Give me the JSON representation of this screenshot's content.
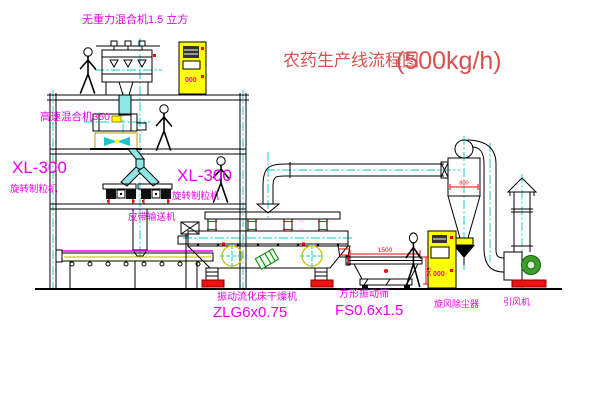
{
  "title": {
    "main": "农药生产线流程图",
    "capacity": "(500kg/h)"
  },
  "labels": {
    "gravity_mixer": "无重力混合机1.5 立方",
    "high_speed_mixer": "高速混合机350",
    "granulator_left_model": "XL-300",
    "granulator_left_name": "旋转制粒机",
    "granulator_right_model": "XL-300",
    "granulator_right_name": "旋转制粒机",
    "belt_conveyor": "皮带输送机",
    "dryer_name": "振动流化床干燥机",
    "dryer_model": "ZLG6x0.75",
    "screen_name": "方形振动筛",
    "screen_model": "FS0.6x1.5",
    "cyclone": "旋风除尘器",
    "fan": "引风机"
  },
  "dimensions": {
    "screen_length": "1500",
    "screen_height": "345",
    "cyclone_diameter": "800"
  },
  "cabinets": {
    "cabinet1_text": "000",
    "cabinet2_text": "000"
  },
  "colors": {
    "label_magenta": "#ee00ee",
    "title_red": "#d95050",
    "dimension_red": "#ff0000",
    "cabinet_yellow": "#ffff00",
    "centerline_cyan": "#00cccc",
    "pipe_cyan": "#8ee6e6",
    "line_black": "#000000"
  }
}
